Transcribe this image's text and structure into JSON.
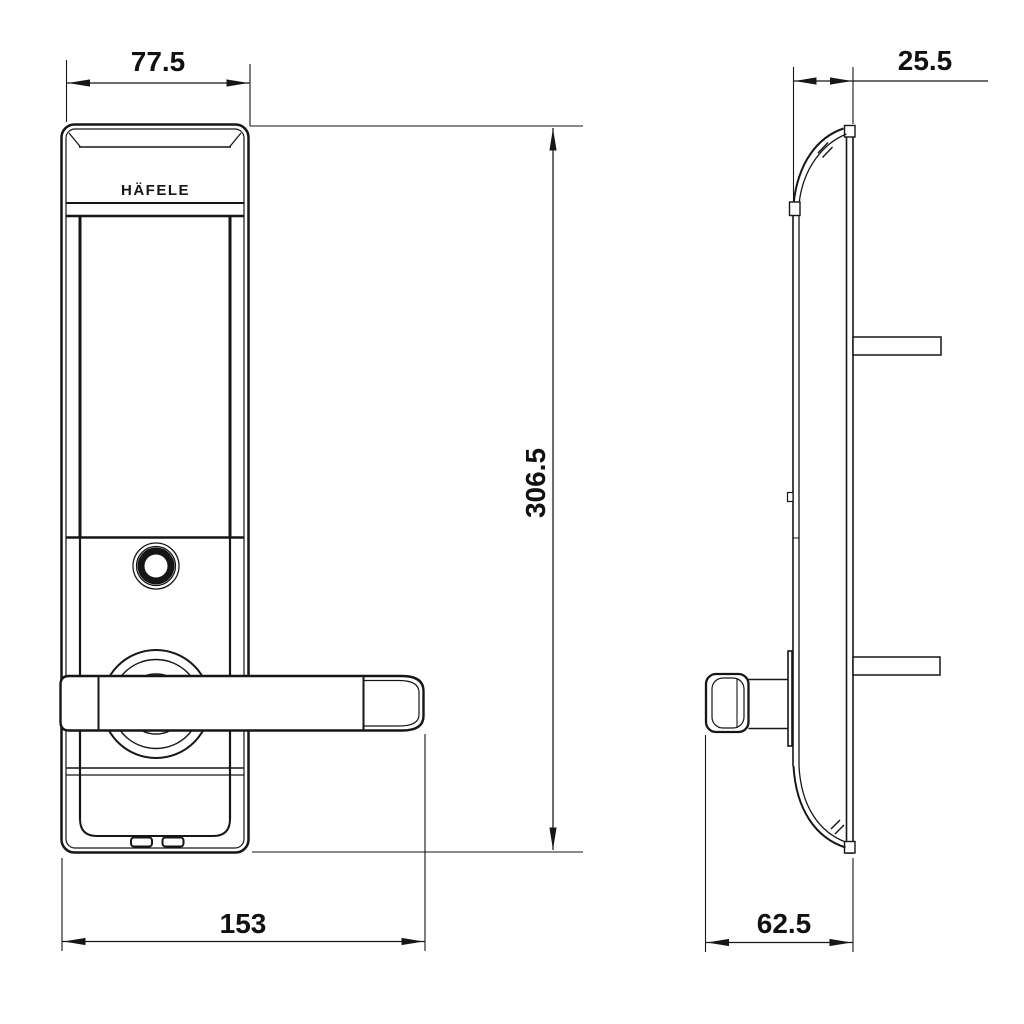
{
  "drawing": {
    "brand": "HÄFELE",
    "dimensions": {
      "front_top_width": "77.5",
      "side_top_depth": "25.5",
      "front_height": "306.5",
      "front_total_width": "153",
      "side_total_depth": "62.5"
    },
    "colors": {
      "line": "#161616",
      "background": "#ffffff"
    }
  }
}
